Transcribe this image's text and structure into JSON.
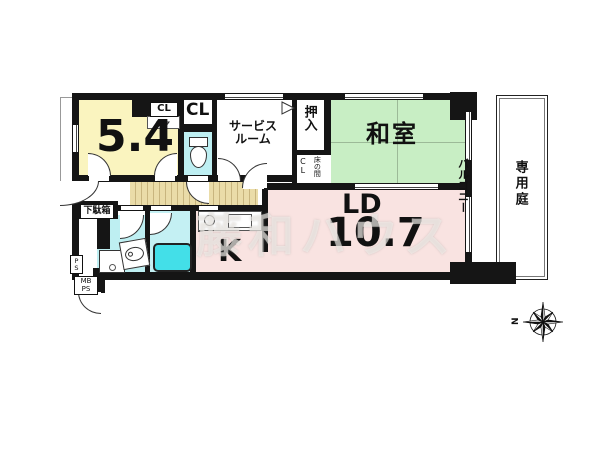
{
  "rooms": {
    "bedroom": {
      "area": "5.4"
    },
    "closet_top": {
      "label": "CL"
    },
    "closet_mid": {
      "label": "CL"
    },
    "service_room": {
      "text": "サービス\nルーム"
    },
    "oshiire": {
      "label": "押入"
    },
    "closet_washitsu": {
      "label": "CL"
    },
    "tokonoma": {
      "label": "床の間"
    },
    "washitsu": {
      "name": "和室"
    },
    "getabako": {
      "label": "下駄箱"
    },
    "kitchen": {
      "name": "K"
    },
    "living_dining": {
      "name": "LD",
      "area": "10.7"
    },
    "balcony": {
      "label": "バルコニー"
    },
    "private_garden": {
      "label": "専用庭"
    },
    "pipe_space": {
      "label": "P\nS"
    },
    "meter_box": {
      "label": "MB\nPS"
    }
  },
  "watermark": {
    "text": "藤和ハウス"
  },
  "compass": {
    "north_label": "N"
  },
  "colors": {
    "bedroom_fill": "#FAF4BF",
    "washitsu_fill": "#C8EEC4",
    "living_fill": "#F9E3E1",
    "wet_area_fill": "#BEEFF2",
    "bathtub_fill": "#43DFE8",
    "hall_floor": "#EADCA8",
    "wall": "#151515"
  }
}
